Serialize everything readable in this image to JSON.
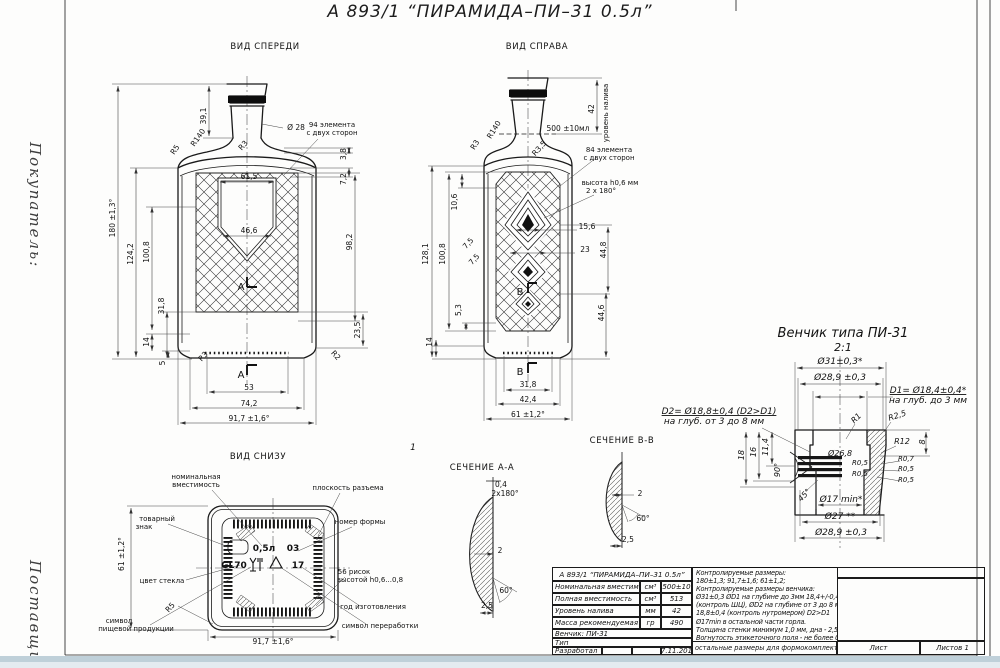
{
  "colors": {
    "line": "#1a1a1a",
    "paper": "#ffffff",
    "strip": "#c9d8e0"
  },
  "page": {
    "title": "А 893/1 “ПИРАМИДА–ПИ–31 0.5л”",
    "margin_buyer": "Покупатель:",
    "margin_supplier": "Поставщик:"
  },
  "views": {
    "front": {
      "title": "ВИД СПЕРЕДИ",
      "annotations": [
        {
          "t": "39,1",
          "x": 206,
          "y": 116,
          "r": -90
        },
        {
          "t": "Ø 28",
          "x": 296,
          "y": 130
        },
        {
          "t": "94 элемента",
          "x": 332,
          "y": 127,
          "fs": 7
        },
        {
          "t": "с двух сторон",
          "x": 332,
          "y": 135,
          "fs": 7
        },
        {
          "t": "R140",
          "x": 200,
          "y": 139,
          "r": -55
        },
        {
          "t": "R5",
          "x": 177,
          "y": 151,
          "r": -55
        },
        {
          "t": "R3",
          "x": 245,
          "y": 147,
          "r": -48
        },
        {
          "t": "3,8",
          "x": 346,
          "y": 154,
          "r": -90
        },
        {
          "t": "7,2",
          "x": 346,
          "y": 179,
          "r": -90
        },
        {
          "t": "61,5",
          "x": 249,
          "y": 179
        },
        {
          "t": "46,6",
          "x": 249,
          "y": 233
        },
        {
          "t": "98,2",
          "x": 352,
          "y": 242,
          "r": -90
        },
        {
          "t": "180 ±1,3°",
          "x": 115,
          "y": 218,
          "r": -90
        },
        {
          "t": "124,2",
          "x": 133,
          "y": 254,
          "r": -90
        },
        {
          "t": "100,8",
          "x": 149,
          "y": 252,
          "r": -90
        },
        {
          "t": "31,8",
          "x": 164,
          "y": 306,
          "r": -90
        },
        {
          "t": "14",
          "x": 149,
          "y": 342,
          "r": -90
        },
        {
          "t": "5",
          "x": 165,
          "y": 363,
          "r": -90
        },
        {
          "t": "23,5",
          "x": 360,
          "y": 330,
          "r": -90
        },
        {
          "t": "R3",
          "x": 205,
          "y": 358,
          "r": -48
        },
        {
          "t": "R2",
          "x": 334,
          "y": 357,
          "r": 48
        },
        {
          "t": "A",
          "x": 241,
          "y": 290,
          "fs": 10
        },
        {
          "t": "A",
          "x": 241,
          "y": 378,
          "fs": 10
        },
        {
          "t": "53",
          "x": 249,
          "y": 390
        },
        {
          "t": "74,2",
          "x": 249,
          "y": 406
        },
        {
          "t": "91,7 ±1,6°",
          "x": 249,
          "y": 421
        }
      ]
    },
    "right": {
      "title": "ВИД СПРАВА",
      "annotations": [
        {
          "t": "уровень налива",
          "x": 608,
          "y": 113,
          "r": -90,
          "fs": 7
        },
        {
          "t": "42",
          "x": 594,
          "y": 109,
          "r": -90
        },
        {
          "t": "500 ±10мл",
          "x": 568,
          "y": 131
        },
        {
          "t": "84 элемента",
          "x": 609,
          "y": 152,
          "fs": 7
        },
        {
          "t": "с двух сторон",
          "x": 609,
          "y": 160,
          "fs": 7
        },
        {
          "t": "высота h0,6 мм",
          "x": 610,
          "y": 185,
          "fs": 7
        },
        {
          "t": "2 x 180°",
          "x": 601,
          "y": 193,
          "fs": 7
        },
        {
          "t": "R140",
          "x": 496,
          "y": 131,
          "r": -58
        },
        {
          "t": "R3",
          "x": 477,
          "y": 146,
          "r": -58
        },
        {
          "t": "R3,5",
          "x": 541,
          "y": 150,
          "r": -48
        },
        {
          "t": "15,6",
          "x": 587,
          "y": 229
        },
        {
          "t": "23",
          "x": 585,
          "y": 252
        },
        {
          "t": "44,8",
          "x": 606,
          "y": 250,
          "r": -90
        },
        {
          "t": "44,6",
          "x": 604,
          "y": 313,
          "r": -90
        },
        {
          "t": "10,6",
          "x": 457,
          "y": 202,
          "r": -90
        },
        {
          "t": "7,5",
          "x": 470,
          "y": 245,
          "r": -48
        },
        {
          "t": "7,5",
          "x": 476,
          "y": 261,
          "r": -48
        },
        {
          "t": "128,1",
          "x": 428,
          "y": 254,
          "r": -90
        },
        {
          "t": "100,8",
          "x": 445,
          "y": 254,
          "r": -90
        },
        {
          "t": "5,3",
          "x": 461,
          "y": 310,
          "r": -90
        },
        {
          "t": "14",
          "x": 432,
          "y": 342,
          "r": -90
        },
        {
          "t": "B",
          "x": 520,
          "y": 295,
          "fs": 10
        },
        {
          "t": "B",
          "x": 520,
          "y": 375,
          "fs": 10
        },
        {
          "t": "31,8",
          "x": 528,
          "y": 387
        },
        {
          "t": "42,4",
          "x": 528,
          "y": 402
        },
        {
          "t": "61 ±1,2°",
          "x": 528,
          "y": 417
        }
      ]
    },
    "bottom": {
      "title": "ВИД СНИЗУ",
      "annotations": [
        {
          "t": "номинальная",
          "x": 196,
          "y": 479,
          "fs": 7
        },
        {
          "t": "вместимость",
          "x": 196,
          "y": 487,
          "fs": 7
        },
        {
          "t": "плоскость разъема",
          "x": 348,
          "y": 490,
          "fs": 7
        },
        {
          "t": "товарный",
          "x": 157,
          "y": 521,
          "fs": 7
        },
        {
          "t": "знак",
          "x": 144,
          "y": 529,
          "fs": 7
        },
        {
          "t": "номер формы",
          "x": 360,
          "y": 524,
          "fs": 7
        },
        {
          "t": "61 ±1,2°",
          "x": 124,
          "y": 554,
          "r": -90
        },
        {
          "t": "цвет стекла",
          "x": 162,
          "y": 583,
          "fs": 7
        },
        {
          "t": "R5",
          "x": 172,
          "y": 609,
          "r": -48
        },
        {
          "t": "символ",
          "x": 119,
          "y": 623,
          "fs": 7
        },
        {
          "t": "пищевой продукции",
          "x": 136,
          "y": 631,
          "fs": 7
        },
        {
          "t": "56 рисок",
          "x": 354,
          "y": 574,
          "fs": 7
        },
        {
          "t": "высотой h0,6...0,8",
          "x": 370,
          "y": 582,
          "fs": 7
        },
        {
          "t": "год изготовления",
          "x": 373,
          "y": 609,
          "fs": 7
        },
        {
          "t": "символ переработки",
          "x": 380,
          "y": 628,
          "fs": 7
        },
        {
          "t": "91,7 ±1,6°",
          "x": 273,
          "y": 644
        },
        {
          "t": "0,5л",
          "x": 264,
          "y": 551,
          "fs": 9,
          "cls": "mark"
        },
        {
          "t": "03",
          "x": 293,
          "y": 551,
          "fs": 9,
          "cls": "mark"
        },
        {
          "t": "GL70",
          "x": 234,
          "y": 568,
          "fs": 9,
          "cls": "mark"
        },
        {
          "t": "17",
          "x": 298,
          "y": 568,
          "fs": 9,
          "cls": "mark"
        }
      ]
    },
    "section_a": {
      "title": "СЕЧЕНИЕ А-А",
      "annotations": [
        {
          "t": "0,4",
          "x": 501,
          "y": 487
        },
        {
          "t": "2x180°",
          "x": 505,
          "y": 496
        },
        {
          "t": "2",
          "x": 500,
          "y": 553
        },
        {
          "t": "60°",
          "x": 506,
          "y": 593
        },
        {
          "t": "2,5",
          "x": 487,
          "y": 608
        }
      ]
    },
    "section_b": {
      "title": "СЕЧЕНИЕ В-В",
      "annotations": [
        {
          "t": "2",
          "x": 640,
          "y": 496
        },
        {
          "t": "60°",
          "x": 643,
          "y": 521
        },
        {
          "t": "2,5",
          "x": 628,
          "y": 542
        }
      ]
    },
    "finish": {
      "title": "Венчик типа ПИ-31",
      "scale": "2:1",
      "annotations": [
        {
          "t": "Ø31±0,3*",
          "x": 840,
          "y": 364,
          "fs": 9
        },
        {
          "t": "Ø28,9 ±0,3",
          "x": 840,
          "y": 380,
          "fs": 9
        },
        {
          "t": "D1= Ø18,4±0,4*",
          "x": 928,
          "y": 393,
          "fs": 9,
          "cls": "ul"
        },
        {
          "t": "на глуб. до 3 мм",
          "x": 928,
          "y": 403,
          "fs": 9
        },
        {
          "t": "D2= Ø18,8±0,4 (D2>D1)",
          "x": 719,
          "y": 414,
          "fs": 9,
          "cls": "ul"
        },
        {
          "t": "на глуб. от 3 до 8 мм",
          "x": 714,
          "y": 424,
          "fs": 9
        },
        {
          "t": "R1",
          "x": 858,
          "y": 420,
          "r": -45,
          "fs": 8
        },
        {
          "t": "R2,5",
          "x": 898,
          "y": 418,
          "r": -18,
          "fs": 8
        },
        {
          "t": "R12",
          "x": 902,
          "y": 444,
          "fs": 8
        },
        {
          "t": "8",
          "x": 925,
          "y": 442,
          "r": -90,
          "fs": 8
        },
        {
          "t": "11,4",
          "x": 768,
          "y": 447,
          "r": -90,
          "fs": 8
        },
        {
          "t": "16",
          "x": 756,
          "y": 452,
          "r": -90,
          "fs": 8
        },
        {
          "t": "18",
          "x": 744,
          "y": 455,
          "r": -90,
          "fs": 8
        },
        {
          "t": "Ø26,8",
          "x": 840,
          "y": 456,
          "fs": 8
        },
        {
          "t": "90°",
          "x": 780,
          "y": 470,
          "r": -90,
          "fs": 8
        },
        {
          "t": "R0,5",
          "x": 860,
          "y": 465,
          "fs": 7
        },
        {
          "t": "R0,5",
          "x": 860,
          "y": 476,
          "fs": 7
        },
        {
          "t": "R0,7",
          "x": 906,
          "y": 461,
          "fs": 7
        },
        {
          "t": "R0,5",
          "x": 906,
          "y": 471,
          "fs": 7
        },
        {
          "t": "R0,5",
          "x": 906,
          "y": 482,
          "fs": 7
        },
        {
          "t": "45°",
          "x": 806,
          "y": 497,
          "r": -45,
          "fs": 8
        },
        {
          "t": "Ø17 min*",
          "x": 841,
          "y": 502,
          "fs": 9
        },
        {
          "t": "Ø27 **",
          "x": 840,
          "y": 519,
          "fs": 9
        },
        {
          "t": "Ø28,9 ±0,3",
          "x": 841,
          "y": 535,
          "fs": 9
        }
      ]
    },
    "misc": {
      "annotations": [
        {
          "t": "1",
          "x": 413,
          "y": 450,
          "fs": 9,
          "cls": "it"
        }
      ]
    }
  },
  "titleblock": {
    "header": "А 893/1 “ПИРАМИДА–ПИ–31 0.5л”",
    "rows": [
      {
        "name": "Номинальная вместимость",
        "unit": "см³",
        "value": "500±10"
      },
      {
        "name": "Полная вместимость",
        "unit": "см³",
        "value": "513"
      },
      {
        "name": "Уровень налива",
        "unit": "мм",
        "value": "42"
      },
      {
        "name": "Масса рекомендуемая",
        "unit": "гр",
        "value": "490"
      }
    ],
    "finish_row": "Венчик: ПИ-31",
    "type_row": "Тип",
    "dev_label": "Разработал",
    "dev_date": "17.11.2017",
    "notes": [
      "Контролируемые размеры:",
      "180±1,3; 91,7±1,6; 61±1,2;",
      "Контролируемые размеры венчика:",
      "Ø31±0,3 ØD1 на глубине до 3мм 18,4+/-0,4",
      "(контроль ШЦ), ØD2 на глубине от 3 до 8 мм",
      "18,8±0,4 (контроль нутромером) D2>D1",
      "Ø17min в остальной части горла.",
      "Толщина стенки минимум 1,0 мм, дна - 2,5 мм",
      "Вогнутость этикеточного поля - не более 0,3мм",
      "остальные размеры для формокомплекта"
    ],
    "sheet_label": "Лист",
    "sheets_label": "Листов 1",
    "copied_label": "Копировал",
    "format_label": "Формат А4"
  }
}
